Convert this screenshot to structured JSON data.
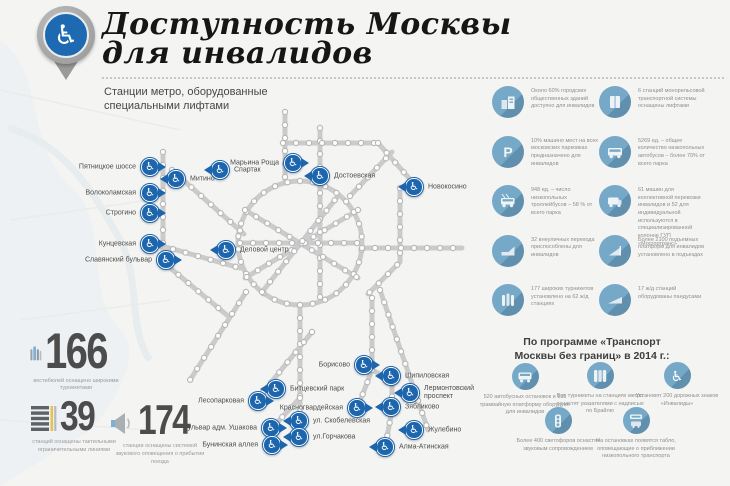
{
  "colors": {
    "accent_blue": "#1d66ad",
    "stat_circle_blue": "#76a9c8",
    "stat_circle_shadow": "#6090ad",
    "metro_line_gray": "#cbcbcb",
    "number_gray": "#4c4c4c",
    "background": "#f4f4f2"
  },
  "icons": {
    "wheelchair": "♿",
    "parking_letter": "P"
  },
  "header": {
    "title_line1": "Доступность Москвы",
    "title_line2": "для инвалидов",
    "subtitle_line1": "Станции метро, оборудованные",
    "subtitle_line2": "специальными лифтами"
  },
  "stations": [
    "Пятницкое шоссе",
    "Митино",
    "Спартак",
    "Марьина Роща",
    "Достоевская",
    "Новокосино",
    "Волоколамская",
    "Строгино",
    "Кунцевская",
    "Славянский бульвар",
    "Деловой центр",
    "Борисово",
    "Шипиловская",
    "Битцевский парк",
    "Лермонтовский проспект",
    "Лесопарковая",
    "Красногвардейская",
    "Зябликово",
    "ул. Скобелевская",
    "Бульвар адм. Ушакова",
    "ул.Горчакова",
    "Жулебино",
    "Бунинская аллея",
    "Алма-Атинская"
  ],
  "stats_right": {
    "col1": [
      {
        "icon": "buildings-icon",
        "text": "Около 60% городских общественных зданий доступно для инвалидов"
      },
      {
        "icon": "parking-icon",
        "text": "10% машино мест на всех московских парковках предназначено для инвалидов"
      },
      {
        "icon": "trolleybus-icon",
        "text": "948 ед. – число низкопольных троллейбусов – 58 % от всего парка"
      },
      {
        "icon": "underpass-icon",
        "text": "32 внеуличных перехода приспособлены для инвалидов"
      },
      {
        "icon": "turnstile-icon",
        "text": "177 широких турникетов установлено на 62 ж/д станциях"
      }
    ],
    "col2": [
      {
        "icon": "elevator-icon",
        "text": "6 станций монорельсовой транспортной системы оснащены лифтами"
      },
      {
        "icon": "bus-icon",
        "text": "5269 ед. – общее количество низкопольных автобусов – более 70% от всего парка"
      },
      {
        "icon": "van-icon",
        "text": "61 машин для коллективной перевозки инвалидов и 52 для индивидуальной используются в специализированной колонне ГУП «Мосгортранс»"
      },
      {
        "icon": "lift-platform-icon",
        "text": "Более 2100 подъемных платформ для инвалидов установлено в подъездах"
      },
      {
        "icon": "ramp-icon",
        "text": "17 ж/д станций оборудованы пандусами"
      }
    ]
  },
  "metro_stats": [
    {
      "value": "166",
      "caption": "вестибюлей оснащено широкими турникетами"
    },
    {
      "value": "39",
      "caption": "станций оснащены тактильными ограничительными линиями"
    },
    {
      "value": "174",
      "caption": "станции оснащены системой звукового оповещения о прибытии поезда"
    }
  ],
  "program": {
    "title_line1": "По программе «Транспорт",
    "title_line2": "Москвы без границ» в 2014 г.:",
    "items": [
      {
        "icon": "bus-icon",
        "text": "520 автобусных остановок и 131 трамвайную платформу оборудуют для инвалидов"
      },
      {
        "icon": "turnstile-braille-icon",
        "text": "Все турникеты на станциях метро оснастят указателями с надписью по Брайлю"
      },
      {
        "icon": "wheelchair-icon",
        "text": "Установят 200 дорожных знаков «Инвалиды»"
      },
      {
        "icon": "traffic-light-icon",
        "text": "Более 400 светофоров оснастят звуковым сопровождением"
      },
      {
        "icon": "arrival-board-icon",
        "text": "На остановках появятся табло, оповещающие о приближении низкопольного транспорта"
      }
    ]
  }
}
